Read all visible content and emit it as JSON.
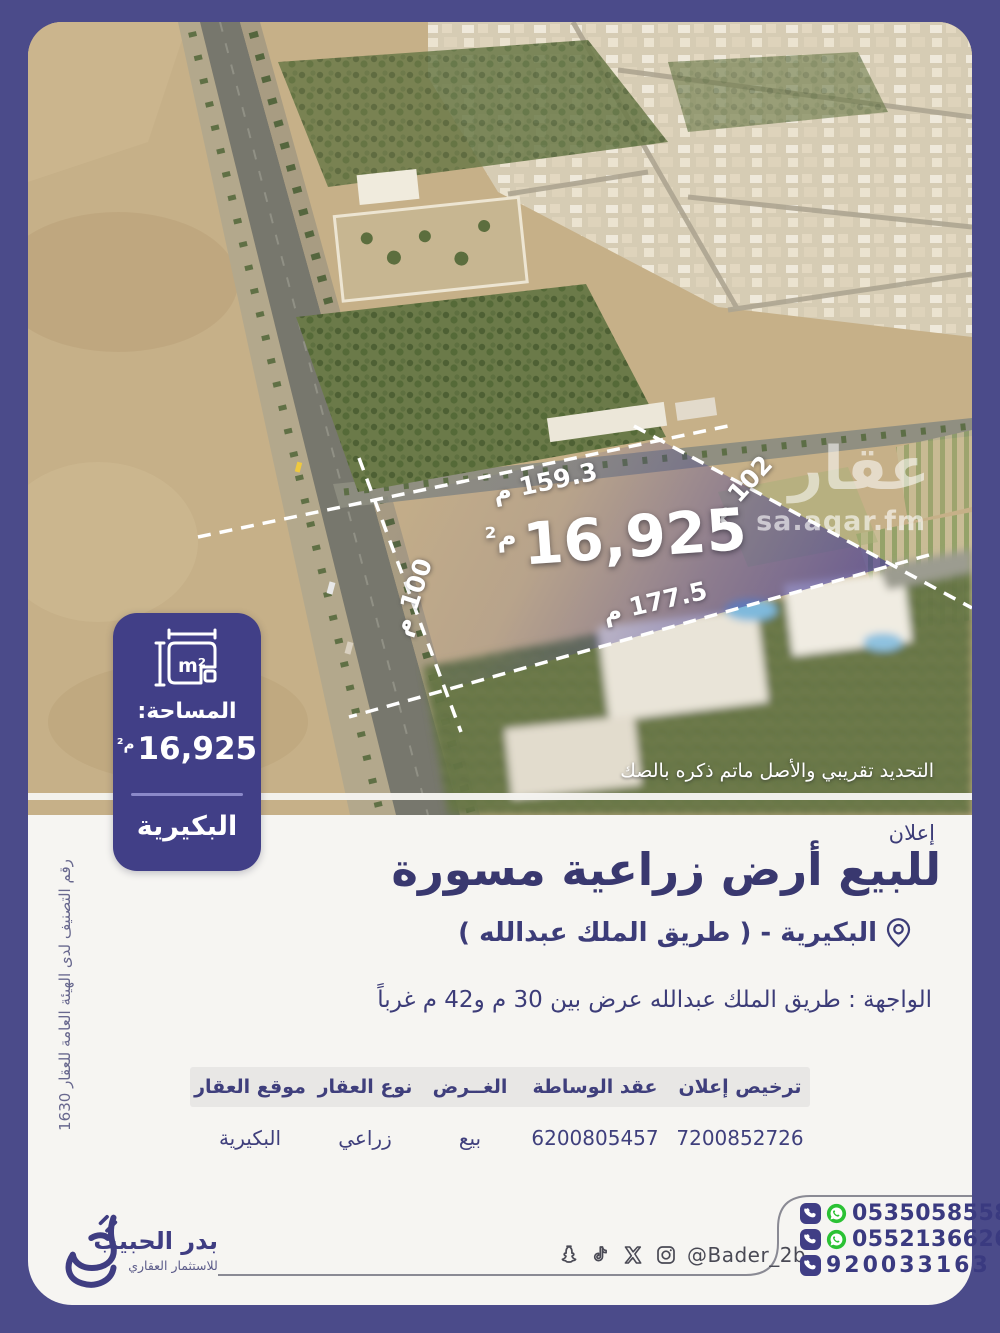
{
  "colors": {
    "page_bg": "#4B4B8A",
    "accent_indigo": "#413F87",
    "text_indigo": "#3C3C78",
    "section_bg": "#F6F5F2",
    "table_header_bg": "#E8E7E5",
    "whatsapp_green": "#2BC234"
  },
  "photo": {
    "watermark_title": "عقار",
    "watermark_url": "sa.aqar.fm",
    "disclaimer": "التحديد تقريبي والأصل ماتم ذكره بالصك",
    "plot": {
      "area_value": "16,925",
      "area_unit": "م²",
      "side_top": "159.3 م",
      "side_right": "102 م",
      "side_left": "100 م",
      "side_bottom": "177.5 م"
    }
  },
  "badge": {
    "icon_label": "m²",
    "label": "المساحة:",
    "value": "16,925",
    "unit": "م²",
    "city": "البكيرية"
  },
  "classification_note": "رقم التصنيف لدى الهيئة العامة للعقار 1630",
  "announcement": {
    "kicker": "إعلان",
    "title": "للبيع أرض زراعية مسورة",
    "location": "البكيرية - ( طريق الملك عبدالله )",
    "frontage": "الواجهة : طريق الملك عبدالله عرض بين 30 م و42 م غرباً"
  },
  "table": {
    "columns": [
      {
        "header": "ترخيص إعلان",
        "value": "7200852726"
      },
      {
        "header": "عقد الوساطة",
        "value": "6200805457"
      },
      {
        "header": "الغــرض",
        "value": "بيع"
      },
      {
        "header": "نوع العقار",
        "value": "زراعي"
      },
      {
        "header": "موقع العقار",
        "value": "البكيرية"
      }
    ]
  },
  "footer": {
    "brand_name": "بدر الحبيب",
    "brand_tagline": "للاستثمار العقاري",
    "social_handle": "@Bader_2b",
    "phones": [
      {
        "number": "0535058558"
      },
      {
        "number": "0552136626"
      },
      {
        "number": "920033163"
      }
    ]
  }
}
